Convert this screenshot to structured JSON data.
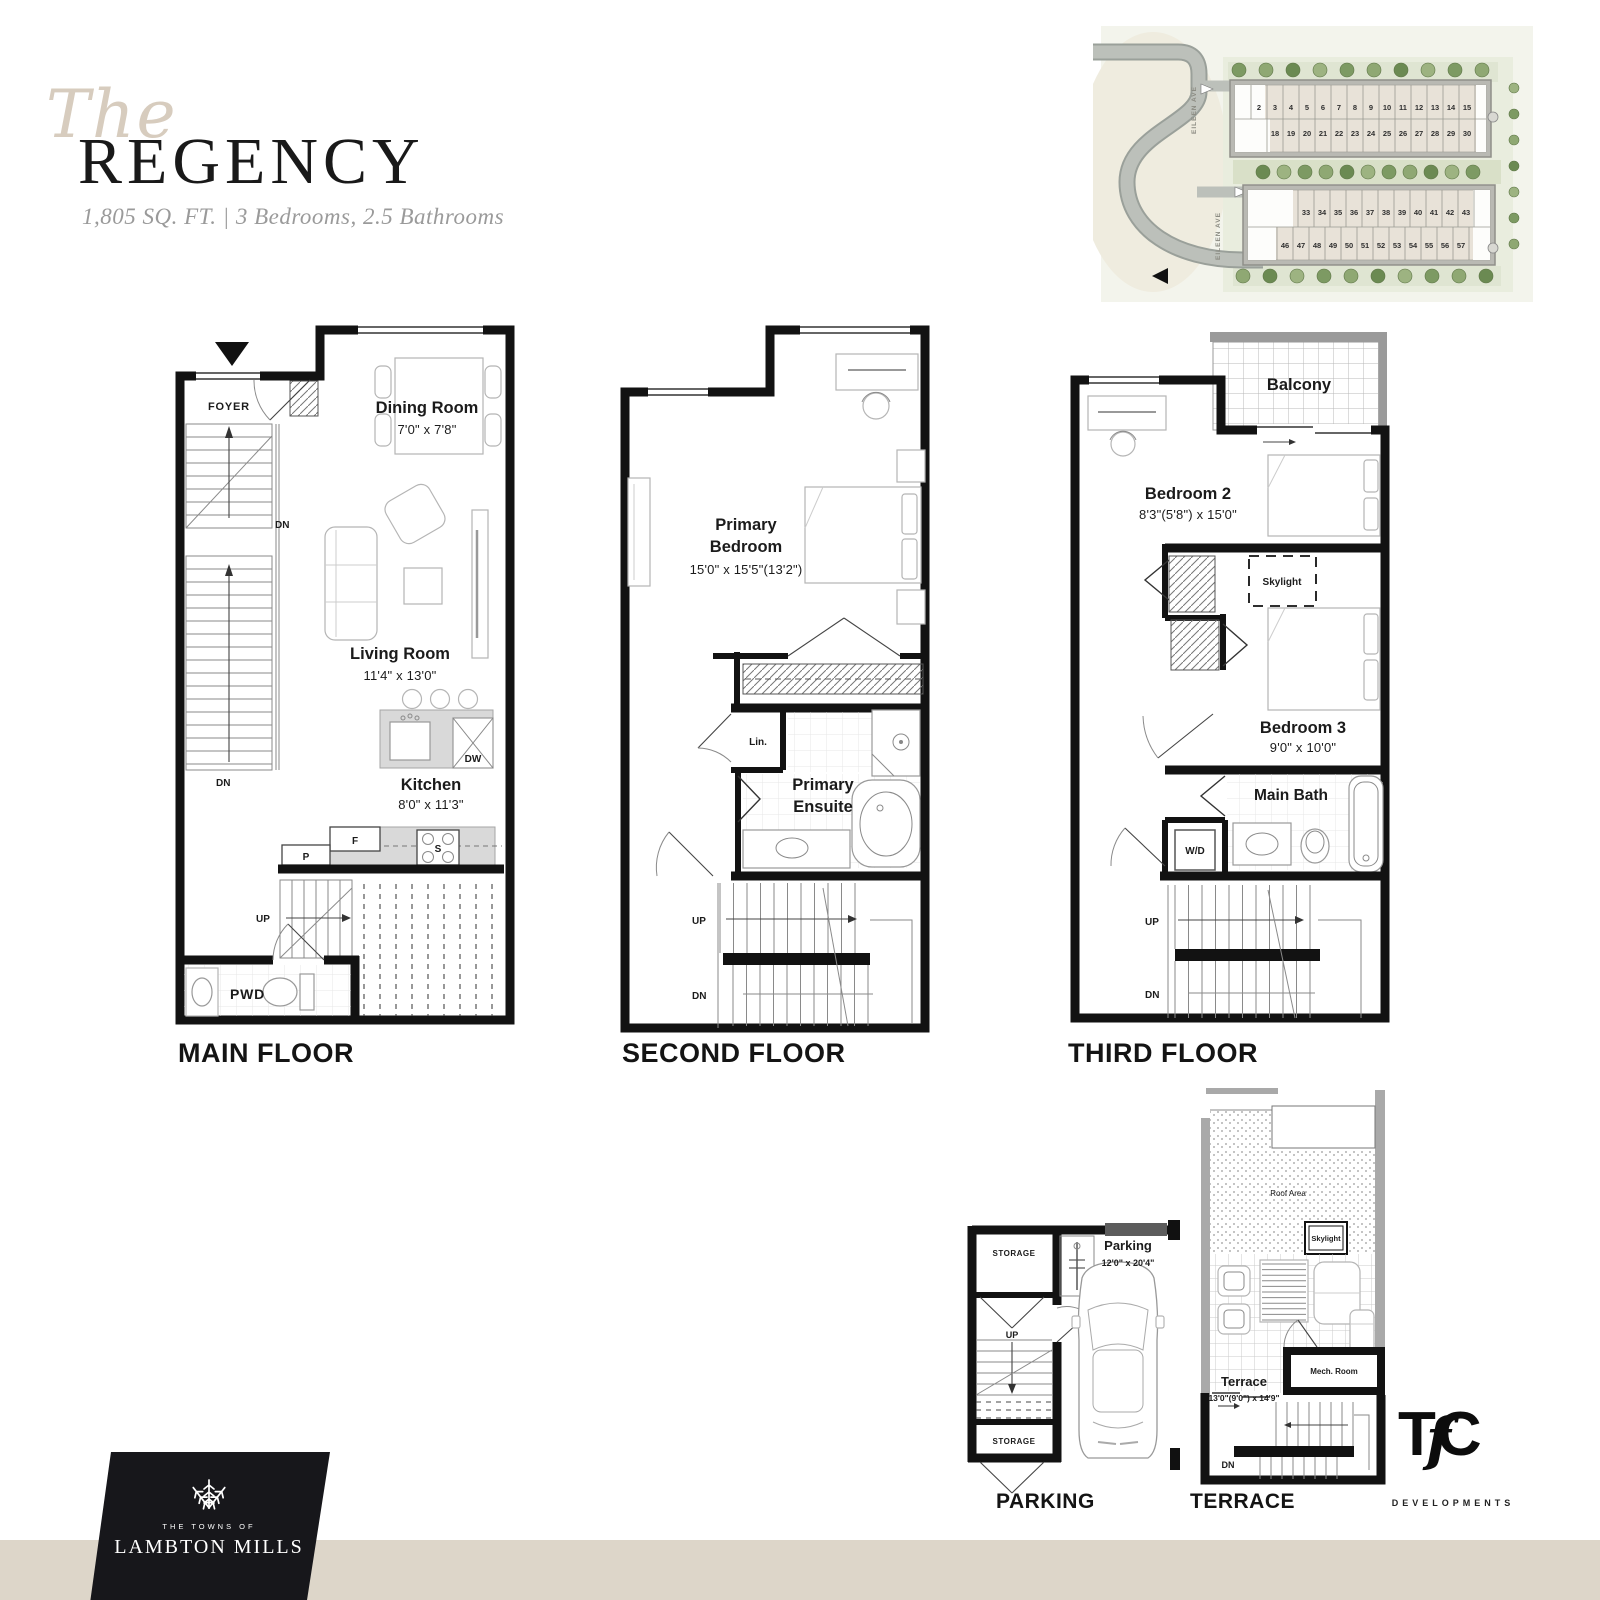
{
  "title": {
    "script": "The",
    "name": "REGENCY",
    "specs": "1,805 SQ. FT. | 3 Bedrooms, 2.5 Bathrooms"
  },
  "site_plan": {
    "street_1": "EILEEN AVE",
    "street_2": "EILEEN AVE",
    "block_a_row_1": [
      "2",
      "3",
      "4",
      "5",
      "6",
      "7",
      "8",
      "9",
      "10",
      "11",
      "12",
      "13",
      "14",
      "15"
    ],
    "block_a_row_2": [
      "18",
      "19",
      "20",
      "21",
      "22",
      "23",
      "24",
      "25",
      "26",
      "27",
      "28",
      "29",
      "30"
    ],
    "block_b_row_1": [
      "33",
      "34",
      "35",
      "36",
      "37",
      "38",
      "39",
      "40",
      "41",
      "42",
      "43"
    ],
    "block_b_row_2": [
      "46",
      "47",
      "48",
      "49",
      "50",
      "51",
      "52",
      "53",
      "54",
      "55",
      "56",
      "57"
    ]
  },
  "floors": {
    "main": {
      "label": "MAIN FLOOR",
      "foyer": "FOYER",
      "dn_upper": "DN",
      "dn_lower": "DN",
      "up": "UP",
      "pwd": "PWD",
      "dining": {
        "name": "Dining Room",
        "dims": "7'0\" x 7'8\""
      },
      "living": {
        "name": "Living Room",
        "dims": "11'4\" x 13'0\""
      },
      "kitchen": {
        "name": "Kitchen",
        "dims": "8'0\" x 11'3\""
      },
      "fridge": "F",
      "pantry": "P",
      "stove": "S",
      "dishwasher": "DW"
    },
    "second": {
      "label": "SECOND FLOOR",
      "up": "UP",
      "dn": "DN",
      "linen": "Lin.",
      "primary_bedroom": {
        "name_line_1": "Primary",
        "name_line_2": "Bedroom",
        "dims": "15'0\" x 15'5\"(13'2\")"
      },
      "ensuite": {
        "name_line_1": "Primary",
        "name_line_2": "Ensuite"
      }
    },
    "third": {
      "label": "THIRD FLOOR",
      "up": "UP",
      "dn": "DN",
      "balcony": "Balcony",
      "skylight": "Skylight",
      "wd": "W/D",
      "bedroom_2": {
        "name": "Bedroom 2",
        "dims": "8'3\"(5'8\") x 15'0\""
      },
      "bedroom_3": {
        "name": "Bedroom 3",
        "dims": "9'0\" x 10'0\""
      },
      "main_bath": "Main Bath"
    },
    "parking": {
      "label": "PARKING",
      "name": "Parking",
      "dims": "12'0\" x 20'4\"",
      "storage_upper": "STORAGE",
      "storage_lower": "STORAGE",
      "up": "UP"
    },
    "terrace": {
      "label": "TERRACE",
      "name": "Terrace",
      "dims": "13'0\"(9'0\") x 14'9\"",
      "roof_area": "Roof Area",
      "skylight": "Skylight",
      "mech_room": "Mech. Room",
      "dn": "DN"
    }
  },
  "logos": {
    "tc": {
      "t": "T",
      "f": "f",
      "c": "C",
      "sub": "DEVELOPMENTS"
    },
    "lambton": {
      "tagline": "THE TOWNS OF",
      "name": "LAMBTON MILLS"
    }
  },
  "colors": {
    "accent_beige": "#ddd6c9",
    "title_script": "#d7ccbe",
    "subtitle_gray": "#9a9a9a",
    "wall_black": "#121212"
  }
}
